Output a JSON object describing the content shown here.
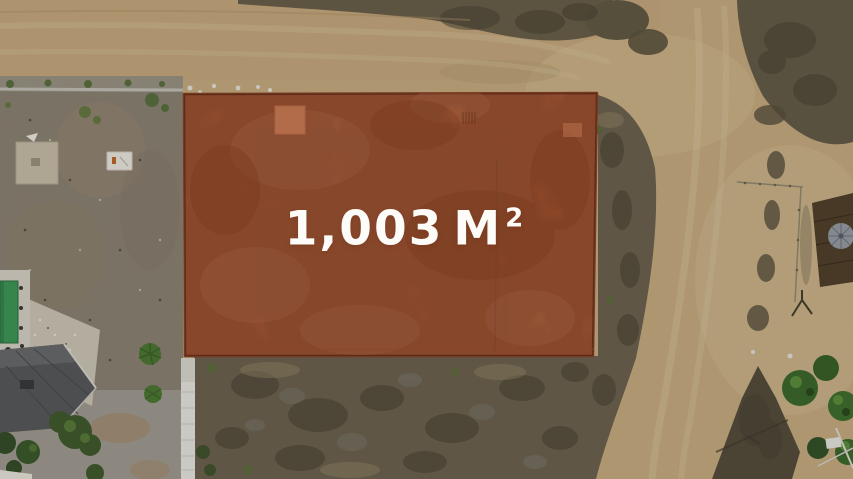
{
  "meta": {
    "image_kind": "aerial-drone-photo",
    "view": "top-down lot-for-sale listing photo"
  },
  "parcel": {
    "area_value": "1,003",
    "area_unit": "M",
    "area_exponent": "2",
    "area_full_text": "1,003 M²"
  },
  "colors": {
    "label-text": "#fdfcf8",
    "parcel-overlay": "#c96a41",
    "parcel-border": "#8a4226",
    "road-sand": "#c8ae85",
    "scrub-dark": "#5e553f",
    "gravel-lot": "#8e8476",
    "pool-water": "#3f9a58",
    "fence-white": "#eae8e1"
  },
  "scene": {
    "features": [
      "dirt-road-horizontal-top",
      "dirt-road-vertical-right",
      "highlighted-parcel-overlay",
      "neighbor-gravel-lot-left",
      "house-with-pool-bottom-left",
      "white-fence-line",
      "scrubland-below-parcel",
      "vegetation-patches",
      "palapa-structure-right",
      "trees-bottom-right"
    ]
  }
}
